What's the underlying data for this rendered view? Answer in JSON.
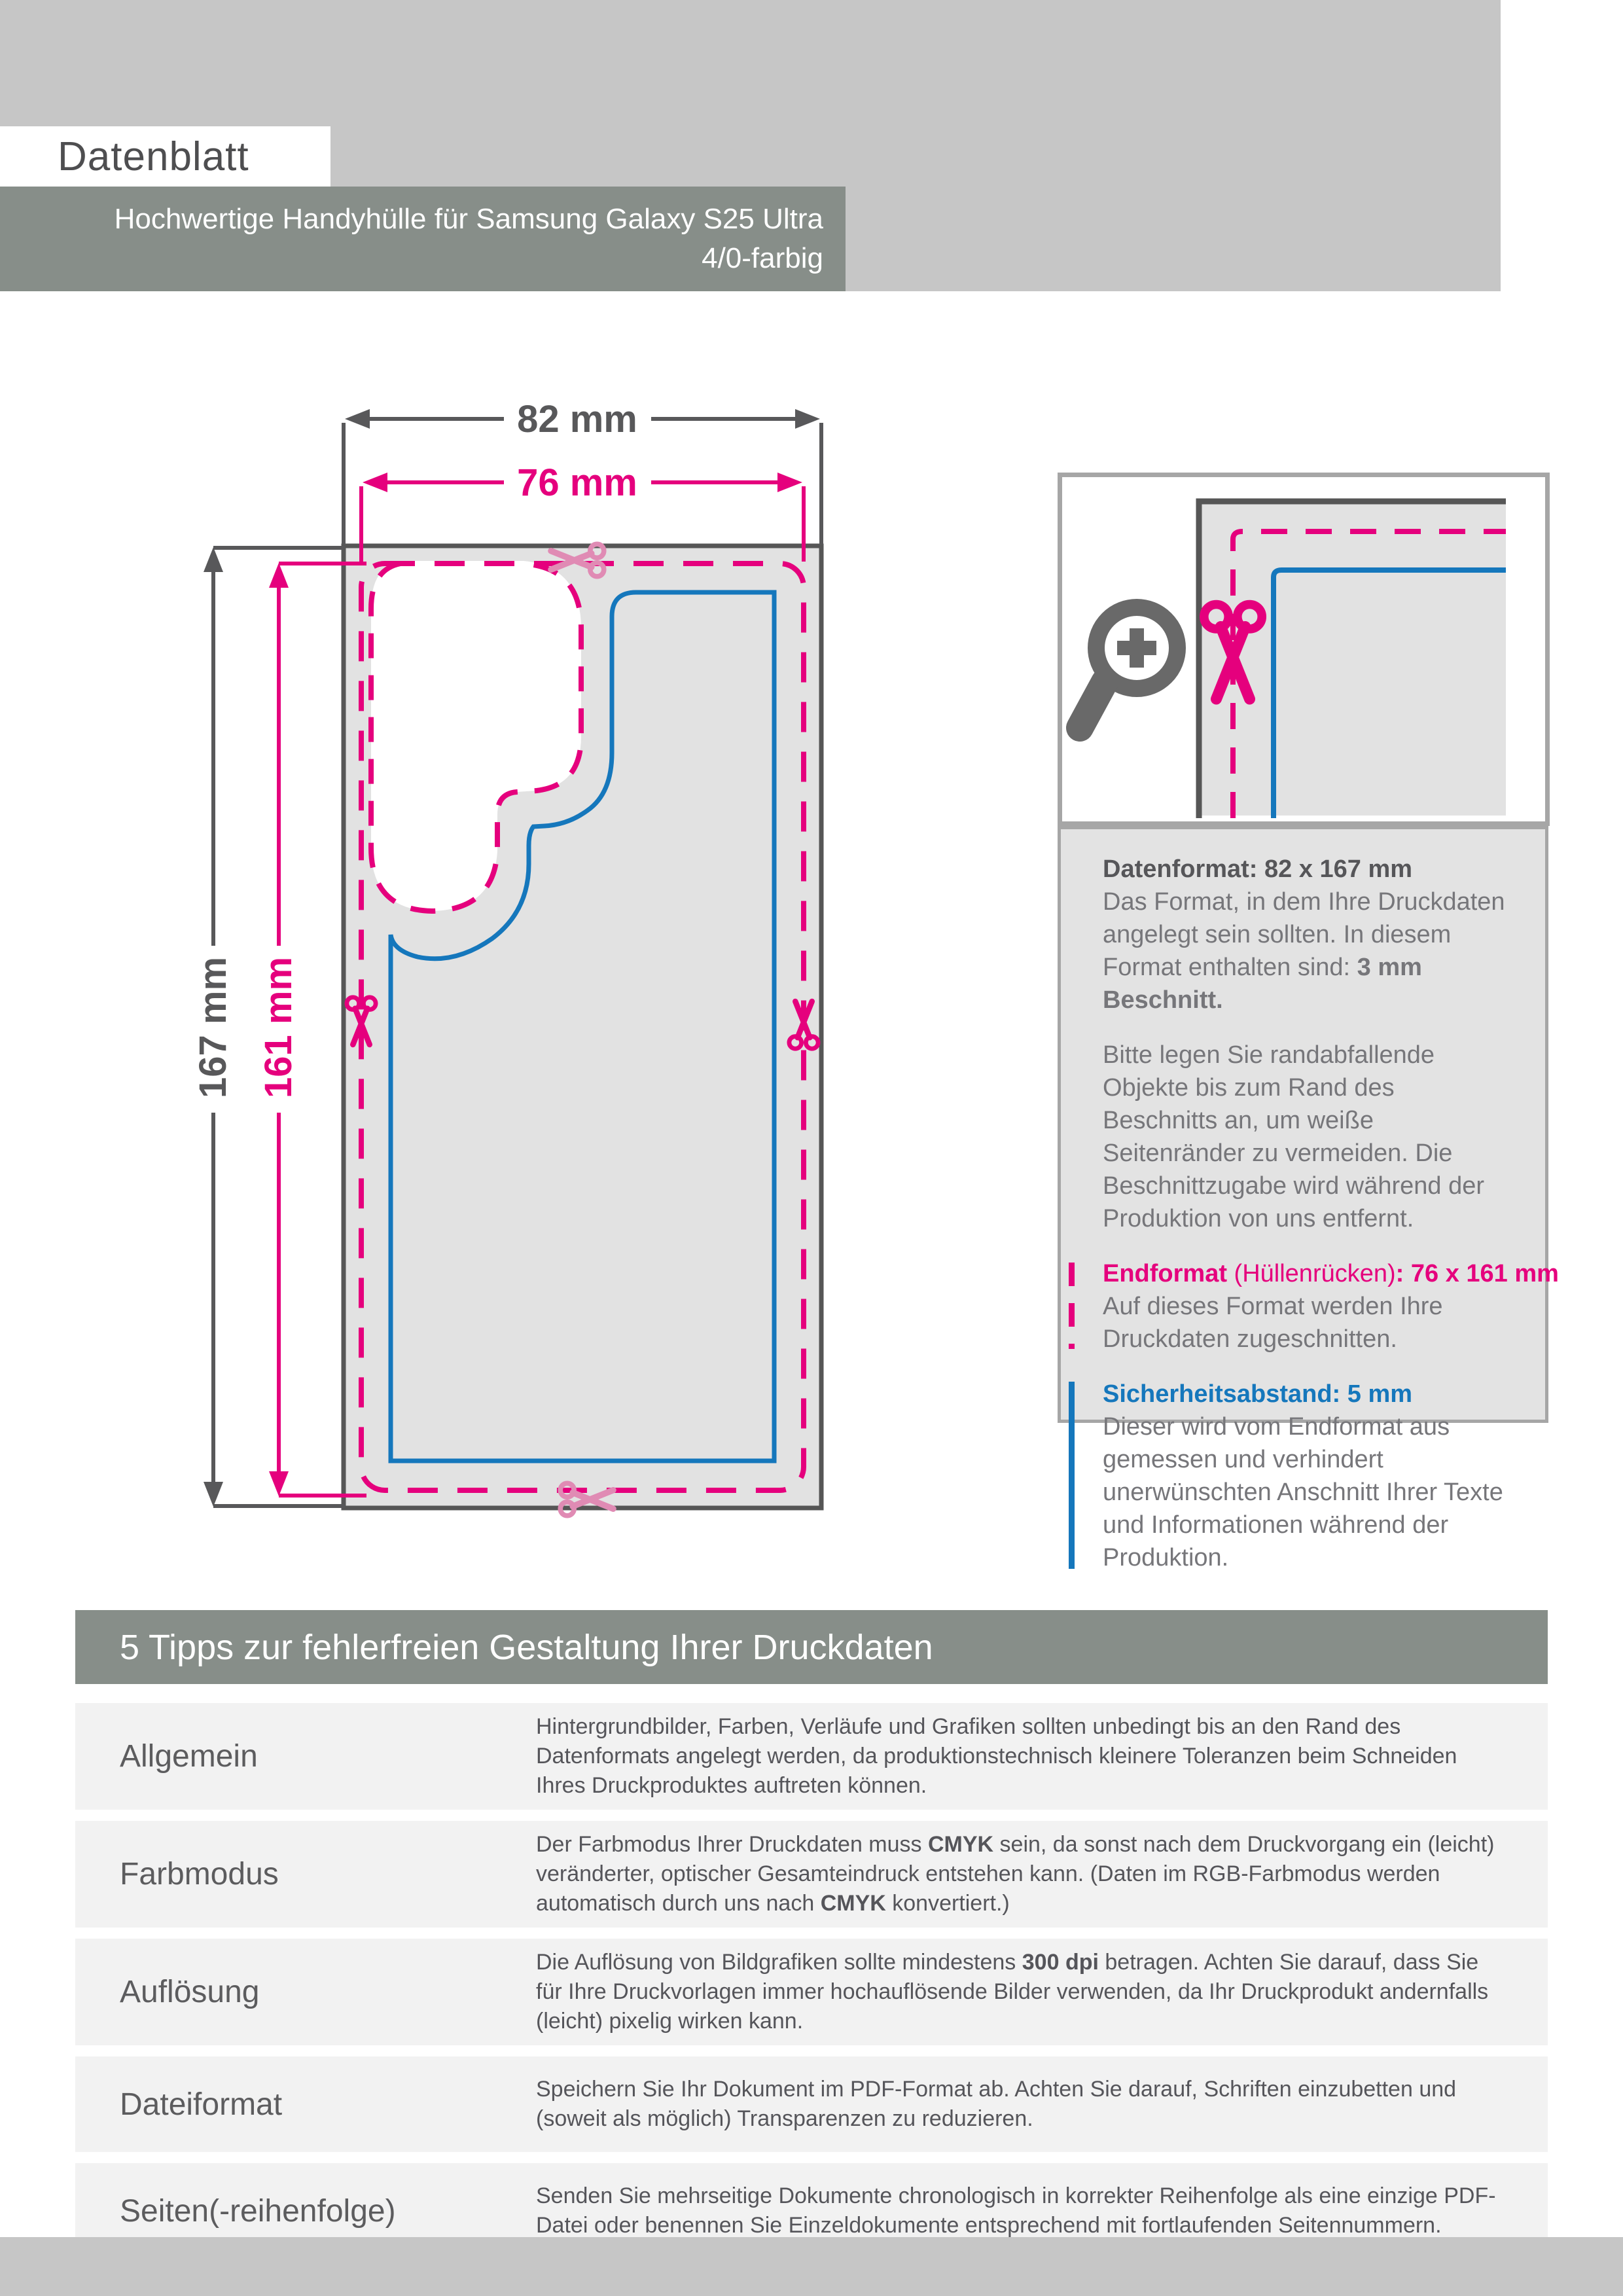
{
  "header": {
    "title": "Datenblatt",
    "subtitle_line1": "Hochwertige Handyhülle für Samsung Galaxy S25 Ultra",
    "subtitle_line2": "4/0-farbig"
  },
  "colors": {
    "magenta": "#e5007d",
    "blue": "#1577bc",
    "dark_line_gray": "#565656",
    "band_gray": "#878e89",
    "light_band_gray": "#c6c6c6",
    "bleed_fill_gray": "#e2e2e2",
    "row_gray": "#f2f2f2"
  },
  "icons": {
    "magnifier": "zoom-in-icon",
    "scissors": "scissors-icon"
  },
  "diagram": {
    "outer_width_label": "82 mm",
    "inner_width_label": "76 mm",
    "outer_height_label": "167 mm",
    "inner_height_label": "161 mm"
  },
  "info_panel": {
    "groups": [
      {
        "bar": "none",
        "sections": [
          {
            "type": "title",
            "segments": [
              {
                "t": "Datenformat: 82 x 167 mm",
                "b": true
              }
            ]
          },
          {
            "type": "para",
            "segments": [
              {
                "t": "Das Format, in dem Ihre Druckdaten angelegt sein sollten. In diesem Format enthalten sind: "
              },
              {
                "t": "3 mm Beschnitt.",
                "b": true
              }
            ]
          },
          {
            "type": "para",
            "segments": [
              {
                "t": "Bitte legen Sie randabfallende Objekte bis zum Rand des Beschnitts an, um weiße Seitenränder zu vermeiden. Die Beschnittzugabe wird während der Produktion von uns entfernt."
              }
            ]
          }
        ]
      },
      {
        "bar": "dashed-pink",
        "sections": [
          {
            "type": "title-pink",
            "segments": [
              {
                "t": "Endformat",
                "b": true
              },
              {
                "t": " (Hüllenrücken)"
              },
              {
                "t": ": 76 x 161 mm",
                "b": true
              }
            ]
          },
          {
            "type": "para",
            "segments": [
              {
                "t": "Auf dieses Format werden Ihre Druckdaten zugeschnitten."
              }
            ]
          }
        ]
      },
      {
        "bar": "solid-blue",
        "sections": [
          {
            "type": "title-blue",
            "segments": [
              {
                "t": "Sicherheitsabstand: 5 mm",
                "b": true
              }
            ]
          },
          {
            "type": "para",
            "segments": [
              {
                "t": "Dieser wird vom Endformat aus gemessen und verhindert unerwünschten Anschnitt Ihrer Texte und Informationen während der Produktion."
              }
            ]
          }
        ]
      }
    ]
  },
  "tips": {
    "header": "5 Tipps zur fehlerfreien Gestaltung Ihrer Druckdaten",
    "rows": [
      {
        "label": "Allgemein",
        "segments": [
          {
            "t": "Hintergrundbilder, Farben, Verläufe und Grafiken sollten unbedingt bis an den Rand des Datenformats angelegt werden, da produktionstechnisch kleinere Toleranzen beim Schneiden Ihres Druckproduktes auftreten können."
          }
        ]
      },
      {
        "label": "Farbmodus",
        "segments": [
          {
            "t": "Der Farbmodus Ihrer Druckdaten muss "
          },
          {
            "t": "CMYK",
            "b": true
          },
          {
            "t": " sein, da sonst nach dem Druckvorgang ein (leicht) veränderter, optischer Gesamteindruck entstehen kann. (Daten im RGB-Farbmodus werden automatisch durch uns nach "
          },
          {
            "t": "CMYK",
            "b": true
          },
          {
            "t": " konvertiert.)"
          }
        ]
      },
      {
        "label": "Auflösung",
        "segments": [
          {
            "t": "Die Auflösung von Bildgrafiken sollte mindestens "
          },
          {
            "t": "300 dpi",
            "b": true
          },
          {
            "t": " betragen. Achten Sie darauf, dass Sie für Ihre Druckvorlagen immer hochauflösende Bilder verwenden, da Ihr Druckprodukt andernfalls (leicht) pixelig wirken kann."
          }
        ]
      },
      {
        "label": "Dateiformat",
        "segments": [
          {
            "t": "Speichern Sie Ihr Dokument im PDF-Format ab. Achten Sie darauf, Schriften einzubetten und (soweit als möglich) Transparenzen zu reduzieren."
          }
        ]
      },
      {
        "label": "Seiten(-reihenfolge)",
        "segments": [
          {
            "t": "Senden Sie mehrseitige Dokumente chronologisch in korrekter Reihenfolge als eine einzige PDF-Datei oder benennen Sie Einzeldokumente entsprechend mit fortlaufenden Seitennummern."
          }
        ]
      }
    ]
  }
}
